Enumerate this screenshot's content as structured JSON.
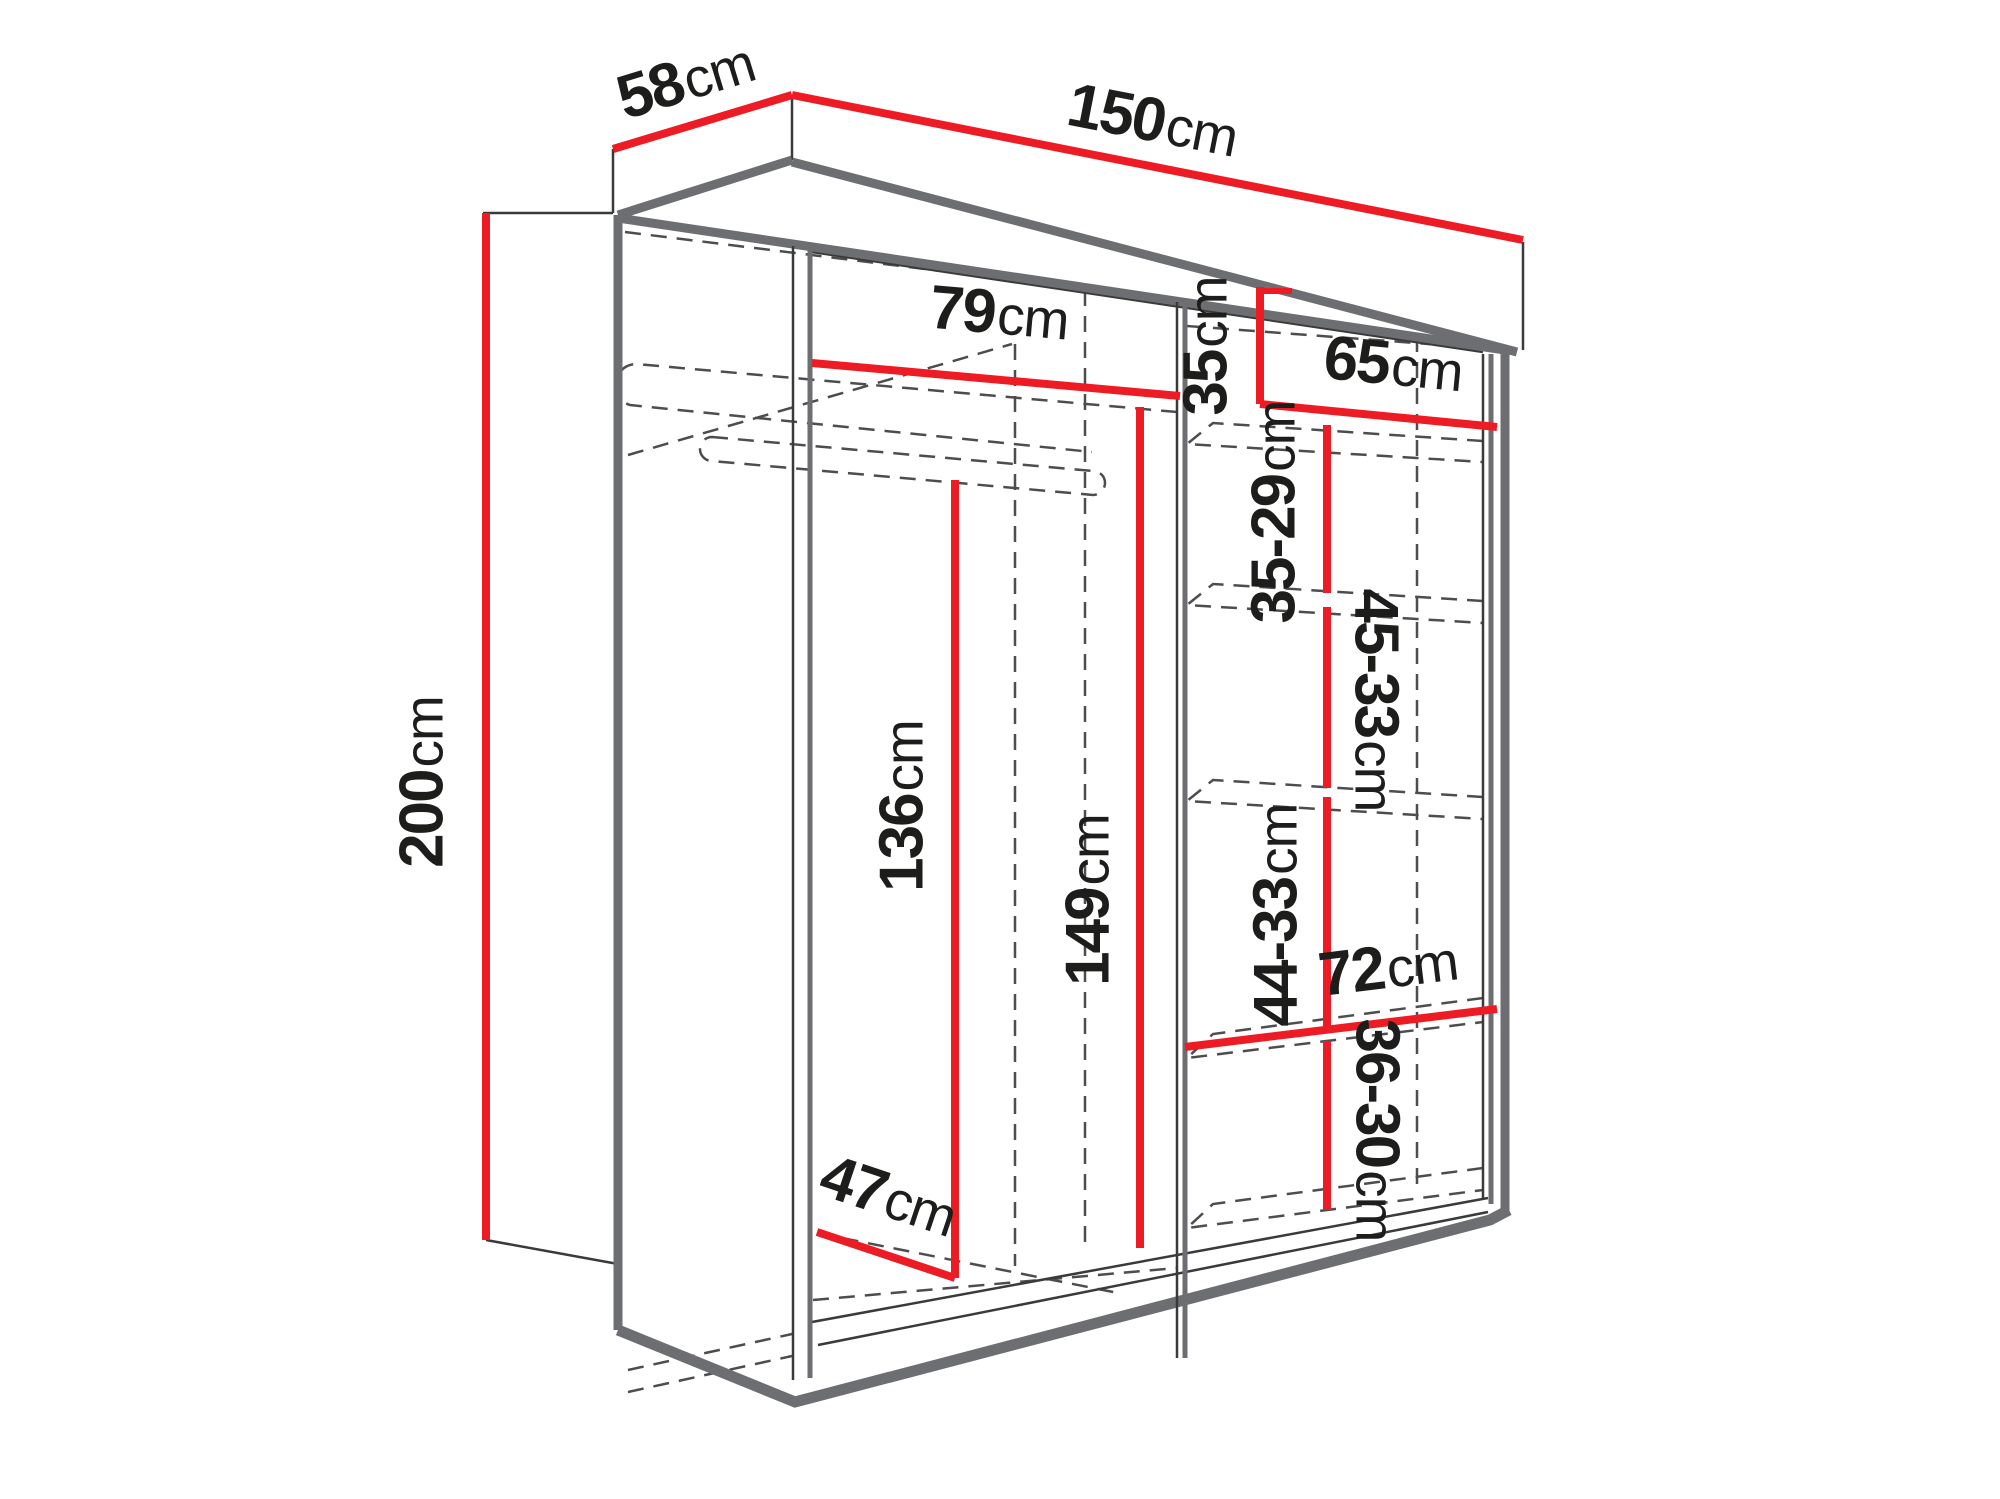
{
  "diagram": {
    "type": "furniture-dimension-diagram",
    "subject": "wardrobe with interior dimensions",
    "unit": "cm",
    "colors": {
      "dimension_line": "#ed1c24",
      "outline": "#6d6e71",
      "thin_line": "#3a3a3a",
      "construction_dashed": "#4d4d4f",
      "label_text": "#1d1d1b",
      "background": "#ffffff"
    },
    "labels": {
      "depth_top": {
        "value": "58",
        "unit": "cm"
      },
      "width_top": {
        "value": "150",
        "unit": "cm"
      },
      "height_left": {
        "value": "200",
        "unit": "cm"
      },
      "left_shelf_width": {
        "value": "79",
        "unit": "cm"
      },
      "right_top_gap": {
        "value": "35",
        "unit": "cm"
      },
      "right_shelf_width": {
        "value": "65",
        "unit": "cm"
      },
      "right_gap_1": {
        "value": "35-29",
        "unit": "cm"
      },
      "right_gap_2": {
        "value": "45-33",
        "unit": "cm"
      },
      "right_gap_3": {
        "value": "44-33",
        "unit": "cm"
      },
      "bottom_shelf_width": {
        "value": "72",
        "unit": "cm"
      },
      "right_gap_4": {
        "value": "36-30",
        "unit": "cm"
      },
      "left_inner_height": {
        "value": "136",
        "unit": "cm"
      },
      "middle_inner_height": {
        "value": "149",
        "unit": "cm"
      },
      "inner_depth": {
        "value": "47",
        "unit": "cm"
      }
    }
  }
}
